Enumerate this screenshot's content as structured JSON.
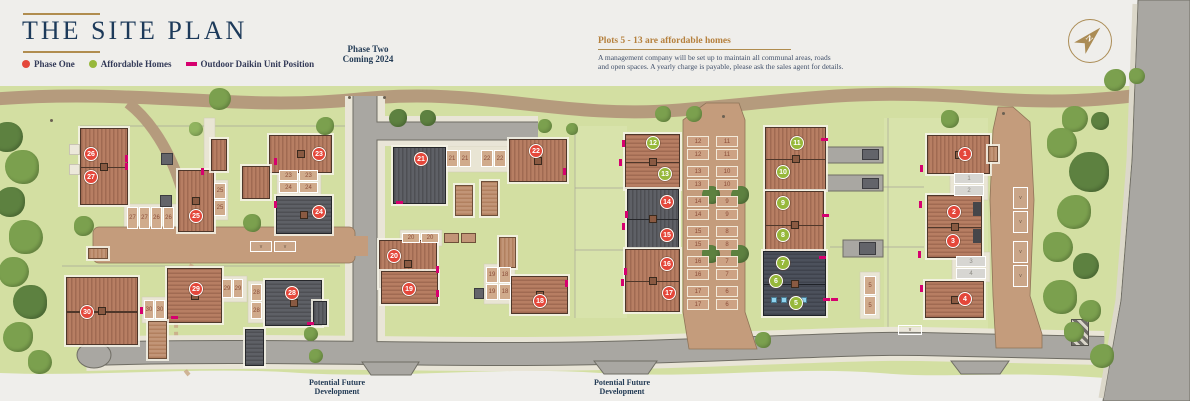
{
  "header": {
    "title": "THE SITE PLAN"
  },
  "legend": [
    {
      "label": "Phase One",
      "swatch": "dot",
      "color": "#e4473a"
    },
    {
      "label": "Affordable Homes",
      "swatch": "dot",
      "color": "#97b83b"
    },
    {
      "label": "Outdoor Daikin Unit Position",
      "swatch": "rect",
      "color": "#d6006e"
    }
  ],
  "notes": {
    "phase_two_line1": "Phase Two",
    "phase_two_line2": "Coming 2024",
    "affordable_heading": "Plots 5 - 13 are affordable homes",
    "management_line1": "A management company will be set up to maintain all communal areas, roads",
    "management_line2": "and open spaces. A yearly charge is payable, please ask the sales agent for details.",
    "future_dev_line1": "Potential Future",
    "future_dev_line2": "Development"
  },
  "compass": {
    "label": "N"
  },
  "theme": {
    "phase_one": "#e4473a",
    "affordable": "#97b83b",
    "daikin": "#d6006e",
    "tree_shades": [
      "#7ba04e",
      "#5d8140",
      "#90b45f"
    ]
  },
  "map": {
    "plots": [
      [
        1,
        965,
        154,
        0
      ],
      [
        2,
        954,
        212,
        0
      ],
      [
        3,
        953,
        241,
        0
      ],
      [
        4,
        965,
        299,
        0
      ],
      [
        5,
        796,
        303,
        1
      ],
      [
        6,
        776,
        281,
        1
      ],
      [
        7,
        783,
        263,
        1
      ],
      [
        8,
        783,
        235,
        1
      ],
      [
        9,
        783,
        203,
        1
      ],
      [
        10,
        783,
        172,
        1
      ],
      [
        11,
        797,
        143,
        1
      ],
      [
        12,
        653,
        143,
        1
      ],
      [
        13,
        665,
        174,
        1
      ],
      [
        14,
        667,
        202,
        0
      ],
      [
        15,
        667,
        235,
        0
      ],
      [
        16,
        667,
        264,
        0
      ],
      [
        17,
        669,
        293,
        0
      ],
      [
        18,
        540,
        301,
        0
      ],
      [
        19,
        409,
        289,
        0
      ],
      [
        20,
        394,
        256,
        0
      ],
      [
        21,
        421,
        159,
        0
      ],
      [
        22,
        536,
        151,
        0
      ],
      [
        23,
        319,
        154,
        0
      ],
      [
        24,
        319,
        212,
        0
      ],
      [
        25,
        196,
        216,
        0
      ],
      [
        26,
        91,
        154,
        0
      ],
      [
        27,
        91,
        177,
        0
      ],
      [
        28,
        292,
        293,
        0
      ],
      [
        29,
        196,
        289,
        0
      ],
      [
        30,
        87,
        312,
        0
      ]
    ],
    "houses": [
      [
        80,
        128,
        48,
        77,
        "red",
        "v",
        1,
        1
      ],
      [
        88,
        248,
        20,
        11,
        "lightb",
        "v",
        0,
        0
      ],
      [
        178,
        170,
        36,
        62,
        "red",
        "v",
        0,
        1
      ],
      [
        211,
        139,
        16,
        32,
        "red",
        "v",
        0,
        0
      ],
      [
        269,
        135,
        63,
        38,
        "red",
        "v",
        0,
        1
      ],
      [
        242,
        166,
        28,
        33,
        "red",
        "v",
        0,
        0
      ],
      [
        276,
        196,
        56,
        38,
        "dark",
        "h",
        0,
        1
      ],
      [
        66,
        277,
        72,
        68,
        "red",
        "v",
        1,
        1
      ],
      [
        167,
        268,
        55,
        55,
        "red",
        "h",
        0,
        1
      ],
      [
        148,
        321,
        19,
        38,
        "lightb",
        "h",
        0,
        0
      ],
      [
        265,
        280,
        57,
        46,
        "dark",
        "h",
        0,
        1
      ],
      [
        245,
        329,
        19,
        37,
        "dark",
        "h",
        0,
        0
      ],
      [
        313,
        301,
        14,
        24,
        "dark",
        "v",
        0,
        0
      ],
      [
        393,
        147,
        53,
        57,
        "dark",
        "v",
        0,
        0
      ],
      [
        509,
        139,
        58,
        43,
        "red",
        "v",
        0,
        1
      ],
      [
        379,
        240,
        58,
        48,
        "red",
        "v",
        0,
        1
      ],
      [
        381,
        271,
        57,
        33,
        "red",
        "h",
        0,
        0
      ],
      [
        511,
        276,
        57,
        38,
        "red",
        "h",
        0,
        1
      ],
      [
        499,
        237,
        17,
        31,
        "lightb",
        "v",
        0,
        0
      ],
      [
        455,
        185,
        18,
        31,
        "lightb",
        "h",
        0,
        0
      ],
      [
        481,
        181,
        17,
        35,
        "lightb",
        "h",
        0,
        0
      ],
      [
        625,
        134,
        55,
        55,
        "red",
        "h",
        1,
        1
      ],
      [
        627,
        189,
        52,
        59,
        "dark",
        "v",
        1,
        1
      ],
      [
        625,
        249,
        55,
        63,
        "red",
        "v",
        1,
        1
      ],
      [
        765,
        127,
        61,
        63,
        "red",
        "v",
        1,
        1
      ],
      [
        765,
        191,
        59,
        67,
        "red",
        "v",
        1,
        1
      ],
      [
        763,
        251,
        63,
        65,
        "dark2",
        "h",
        1,
        1
      ],
      [
        927,
        135,
        63,
        39,
        "red",
        "v",
        0,
        1
      ],
      [
        927,
        195,
        55,
        63,
        "red",
        "h",
        1,
        1
      ],
      [
        925,
        281,
        59,
        37,
        "red",
        "h",
        0,
        1
      ],
      [
        988,
        146,
        10,
        16,
        "lightb",
        "v",
        0,
        0
      ]
    ],
    "bays": [
      [
        "12",
        687,
        136,
        22,
        11,
        "c"
      ],
      [
        "12",
        687,
        149,
        22,
        11,
        "c"
      ],
      [
        "13",
        687,
        166,
        22,
        11,
        "c"
      ],
      [
        "13",
        687,
        179,
        22,
        11,
        "c"
      ],
      [
        "14",
        687,
        196,
        22,
        11,
        "c"
      ],
      [
        "14",
        687,
        209,
        22,
        11,
        "c"
      ],
      [
        "15",
        687,
        226,
        22,
        11,
        "c"
      ],
      [
        "15",
        687,
        239,
        22,
        11,
        "c"
      ],
      [
        "16",
        687,
        256,
        22,
        11,
        "c"
      ],
      [
        "16",
        687,
        269,
        22,
        11,
        "c"
      ],
      [
        "17",
        687,
        286,
        22,
        11,
        "c"
      ],
      [
        "17",
        687,
        299,
        22,
        11,
        "c"
      ],
      [
        "11",
        716,
        136,
        22,
        11,
        "c"
      ],
      [
        "11",
        716,
        149,
        22,
        11,
        "c"
      ],
      [
        "10",
        716,
        166,
        22,
        11,
        "c"
      ],
      [
        "10",
        716,
        179,
        22,
        11,
        "c"
      ],
      [
        "9",
        716,
        196,
        22,
        11,
        "c"
      ],
      [
        "9",
        716,
        209,
        22,
        11,
        "c"
      ],
      [
        "8",
        716,
        226,
        22,
        11,
        "c"
      ],
      [
        "8",
        716,
        239,
        22,
        11,
        "c"
      ],
      [
        "7",
        716,
        256,
        22,
        11,
        "c"
      ],
      [
        "7",
        716,
        269,
        22,
        11,
        "c"
      ],
      [
        "6",
        716,
        286,
        22,
        11,
        "c"
      ],
      [
        "6",
        716,
        299,
        22,
        11,
        "c"
      ],
      [
        "27",
        127,
        207,
        11,
        22,
        "t"
      ],
      [
        "27",
        139,
        207,
        11,
        22,
        "t"
      ],
      [
        "26",
        151,
        207,
        11,
        22,
        "t"
      ],
      [
        "26",
        163,
        207,
        11,
        22,
        "t"
      ],
      [
        "25",
        214,
        183,
        12,
        16,
        "t"
      ],
      [
        "25",
        214,
        200,
        12,
        16,
        "t"
      ],
      [
        "23",
        279,
        170,
        19,
        11,
        "t"
      ],
      [
        "23",
        299,
        170,
        19,
        11,
        "t"
      ],
      [
        "24",
        279,
        182,
        19,
        11,
        "t"
      ],
      [
        "24",
        299,
        182,
        19,
        11,
        "t"
      ],
      [
        "30",
        144,
        300,
        10,
        19,
        "t"
      ],
      [
        "30",
        155,
        300,
        10,
        19,
        "t"
      ],
      [
        "29",
        222,
        279,
        10,
        19,
        "t"
      ],
      [
        "29",
        233,
        279,
        10,
        19,
        "t"
      ],
      [
        "28",
        251,
        284,
        11,
        17,
        "t"
      ],
      [
        "28",
        251,
        302,
        11,
        17,
        "t"
      ],
      [
        "21",
        446,
        150,
        12,
        17,
        "t"
      ],
      [
        "21",
        459,
        150,
        12,
        17,
        "t"
      ],
      [
        "22",
        481,
        150,
        12,
        17,
        "t"
      ],
      [
        "22",
        494,
        150,
        12,
        17,
        "t"
      ],
      [
        "20",
        402,
        233,
        18,
        10,
        "t"
      ],
      [
        "20",
        421,
        233,
        18,
        10,
        "t"
      ],
      [
        "19",
        486,
        267,
        12,
        16,
        "t"
      ],
      [
        "18",
        499,
        267,
        12,
        16,
        "t"
      ],
      [
        "19",
        486,
        284,
        12,
        16,
        "t"
      ],
      [
        "18",
        499,
        284,
        12,
        16,
        "t"
      ],
      [
        "1",
        954,
        173,
        30,
        11,
        "g"
      ],
      [
        "2",
        954,
        185,
        30,
        11,
        "g"
      ],
      [
        "3",
        956,
        256,
        30,
        11,
        "g"
      ],
      [
        "4",
        956,
        268,
        30,
        11,
        "g"
      ],
      [
        "5",
        864,
        276,
        12,
        19,
        "t"
      ],
      [
        "5",
        864,
        296,
        12,
        19,
        "t"
      ],
      [
        "v",
        1013,
        187,
        15,
        22,
        "v"
      ],
      [
        "v",
        1013,
        211,
        15,
        22,
        "v"
      ],
      [
        "v",
        1013,
        241,
        15,
        22,
        "v"
      ],
      [
        "v",
        1013,
        265,
        15,
        22,
        "v"
      ],
      [
        "v",
        898,
        325,
        24,
        10,
        "v"
      ],
      [
        "v",
        250,
        241,
        22,
        11,
        "v"
      ],
      [
        "v",
        274,
        241,
        22,
        11,
        "v"
      ]
    ],
    "trees": [
      [
        220,
        99,
        11,
        0
      ],
      [
        663,
        114,
        8,
        0
      ],
      [
        694,
        114,
        8,
        0
      ],
      [
        950,
        119,
        9,
        0
      ],
      [
        1075,
        119,
        13,
        0
      ],
      [
        1100,
        121,
        9,
        1
      ],
      [
        398,
        118,
        9,
        1
      ],
      [
        428,
        118,
        8,
        1
      ],
      [
        545,
        126,
        7,
        0
      ],
      [
        572,
        129,
        6,
        0
      ],
      [
        1115,
        80,
        11,
        0
      ],
      [
        1137,
        76,
        8,
        0
      ],
      [
        1062,
        143,
        15,
        0
      ],
      [
        1089,
        172,
        20,
        1
      ],
      [
        1074,
        212,
        17,
        0
      ],
      [
        1058,
        247,
        15,
        0
      ],
      [
        1086,
        266,
        13,
        1
      ],
      [
        1060,
        297,
        17,
        0
      ],
      [
        1090,
        311,
        11,
        0
      ],
      [
        1074,
        332,
        10,
        0
      ],
      [
        8,
        137,
        15,
        1
      ],
      [
        22,
        167,
        17,
        0
      ],
      [
        10,
        202,
        15,
        1
      ],
      [
        26,
        237,
        17,
        0
      ],
      [
        14,
        272,
        15,
        0
      ],
      [
        30,
        302,
        17,
        1
      ],
      [
        18,
        337,
        15,
        0
      ],
      [
        40,
        362,
        12,
        0
      ],
      [
        84,
        226,
        10,
        0
      ],
      [
        711,
        195,
        9,
        1
      ],
      [
        740,
        195,
        9,
        1
      ],
      [
        711,
        254,
        9,
        1
      ],
      [
        740,
        254,
        9,
        1
      ],
      [
        252,
        223,
        9,
        0
      ],
      [
        325,
        126,
        9,
        0
      ],
      [
        311,
        334,
        7,
        0
      ],
      [
        316,
        356,
        7,
        0
      ],
      [
        763,
        340,
        8,
        0
      ],
      [
        1102,
        356,
        12,
        0
      ],
      [
        196,
        129,
        7,
        2
      ]
    ],
    "daikin_units": [
      [
        125,
        155,
        1
      ],
      [
        125,
        163,
        1
      ],
      [
        201,
        168,
        1
      ],
      [
        274,
        158,
        1
      ],
      [
        274,
        201,
        1
      ],
      [
        140,
        307,
        1
      ],
      [
        171,
        316,
        0
      ],
      [
        307,
        322,
        0
      ],
      [
        396,
        201,
        0
      ],
      [
        436,
        266,
        1
      ],
      [
        436,
        290,
        1
      ],
      [
        565,
        280,
        1
      ],
      [
        563,
        168,
        1
      ],
      [
        622,
        140,
        1
      ],
      [
        619,
        159,
        1
      ],
      [
        625,
        211,
        1
      ],
      [
        622,
        223,
        1
      ],
      [
        624,
        268,
        1
      ],
      [
        621,
        279,
        1
      ],
      [
        821,
        138,
        0
      ],
      [
        822,
        214,
        0
      ],
      [
        819,
        256,
        0
      ],
      [
        920,
        165,
        1
      ],
      [
        919,
        201,
        1
      ],
      [
        918,
        251,
        1
      ],
      [
        920,
        285,
        1
      ],
      [
        823,
        298,
        0
      ],
      [
        831,
        298,
        0
      ]
    ],
    "features": [
      [
        "patio",
        69,
        144,
        11,
        11
      ],
      [
        "patio",
        69,
        164,
        11,
        11
      ],
      [
        "bin",
        161,
        153,
        12,
        12
      ],
      [
        "bin",
        160,
        195,
        12,
        12
      ],
      [
        "bin",
        862,
        149,
        17,
        11
      ],
      [
        "bin",
        862,
        178,
        17,
        11
      ],
      [
        "bin",
        859,
        242,
        17,
        13
      ],
      [
        "bin",
        474,
        288,
        10,
        11
      ],
      [
        "garage",
        444,
        233,
        15,
        10
      ],
      [
        "garage",
        461,
        233,
        15,
        10
      ],
      [
        "winblue",
        771,
        297,
        6,
        6
      ],
      [
        "winblue",
        781,
        297,
        6,
        6
      ],
      [
        "winblue",
        791,
        297,
        6,
        6
      ],
      [
        "winblue",
        801,
        297,
        6,
        6
      ],
      [
        "windark",
        973,
        202,
        8,
        14
      ],
      [
        "windark",
        973,
        229,
        8,
        14
      ],
      [
        "crossing",
        1071,
        319,
        18,
        27
      ],
      [
        "dot",
        348,
        96,
        3,
        3
      ],
      [
        "dot",
        383,
        96,
        3,
        3
      ],
      [
        "dot",
        50,
        119,
        3,
        3
      ],
      [
        "dot",
        722,
        115,
        3,
        3
      ],
      [
        "dot",
        1002,
        112,
        3,
        3
      ]
    ]
  }
}
